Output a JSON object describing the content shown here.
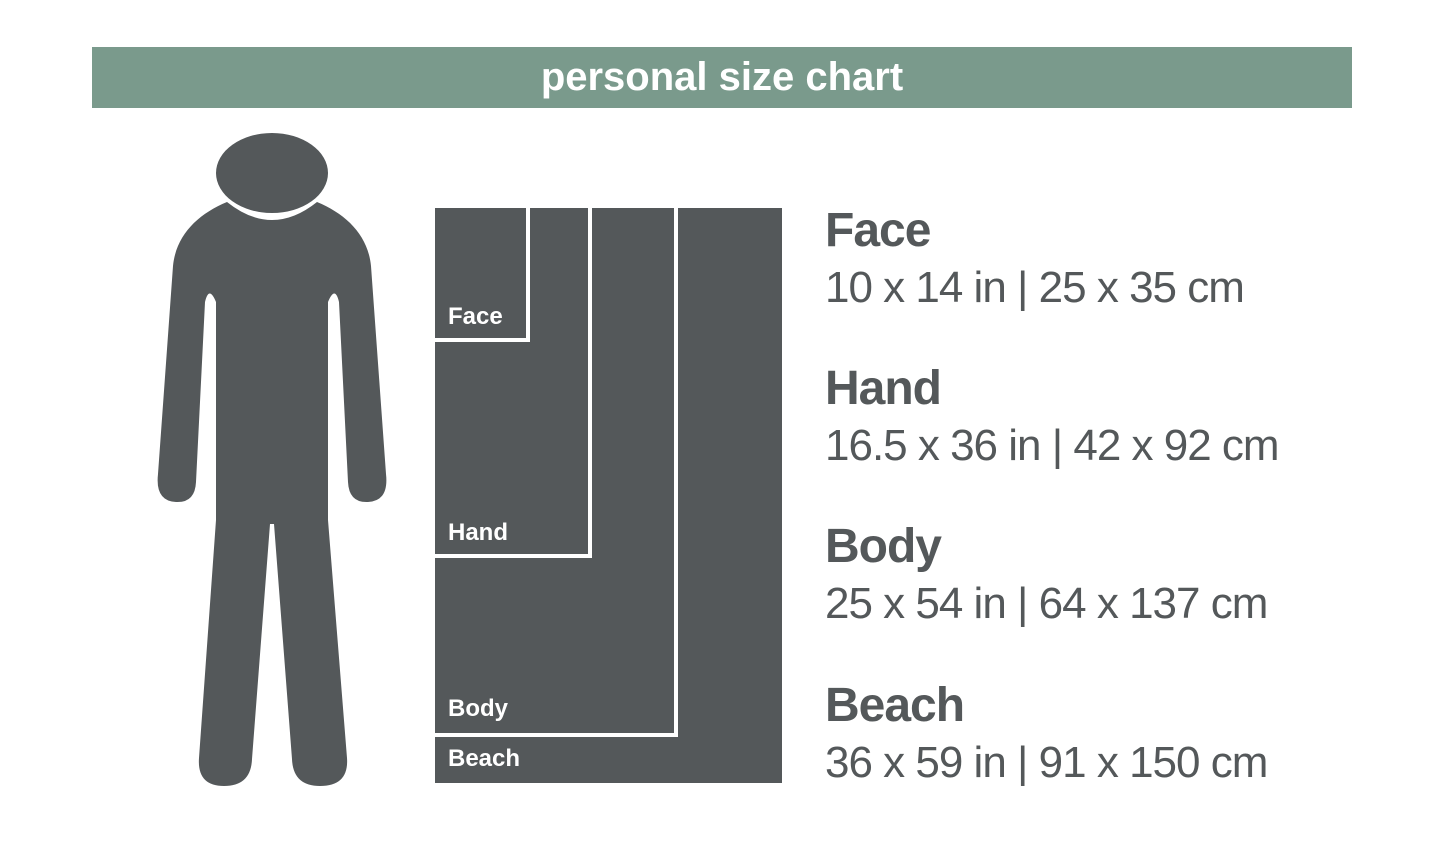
{
  "title": "personal size chart",
  "colors": {
    "header_bg": "#7a9a8c",
    "figure": "#54585a",
    "text": "#54585a",
    "background": "#ffffff"
  },
  "icons": {
    "person": "person-silhouette-icon"
  },
  "boxes": [
    {
      "label": "Face"
    },
    {
      "label": "Hand"
    },
    {
      "label": "Body"
    },
    {
      "label": "Beach"
    }
  ],
  "sizes": [
    {
      "name": "Face",
      "dimensions": "10 x 14 in | 25 x 35 cm"
    },
    {
      "name": "Hand",
      "dimensions": "16.5 x 36 in | 42 x 92 cm"
    },
    {
      "name": "Body",
      "dimensions": "25 x 54 in | 64 x 137 cm"
    },
    {
      "name": "Beach",
      "dimensions": "36 x 59 in | 91 x 150 cm"
    }
  ],
  "chart_data": {
    "type": "table",
    "title": "personal size chart",
    "categories": [
      "Face",
      "Hand",
      "Body",
      "Beach"
    ],
    "series": [
      {
        "name": "width_in",
        "values": [
          10,
          16.5,
          25,
          36
        ]
      },
      {
        "name": "height_in",
        "values": [
          14,
          36,
          54,
          59
        ]
      },
      {
        "name": "width_cm",
        "values": [
          25,
          42,
          64,
          91
        ]
      },
      {
        "name": "height_cm",
        "values": [
          35,
          92,
          137,
          150
        ]
      }
    ],
    "legend_position": "right",
    "layout": "nested rectangles drawn to scale, anchored at shared top-left corner, beside human figure for scale"
  }
}
